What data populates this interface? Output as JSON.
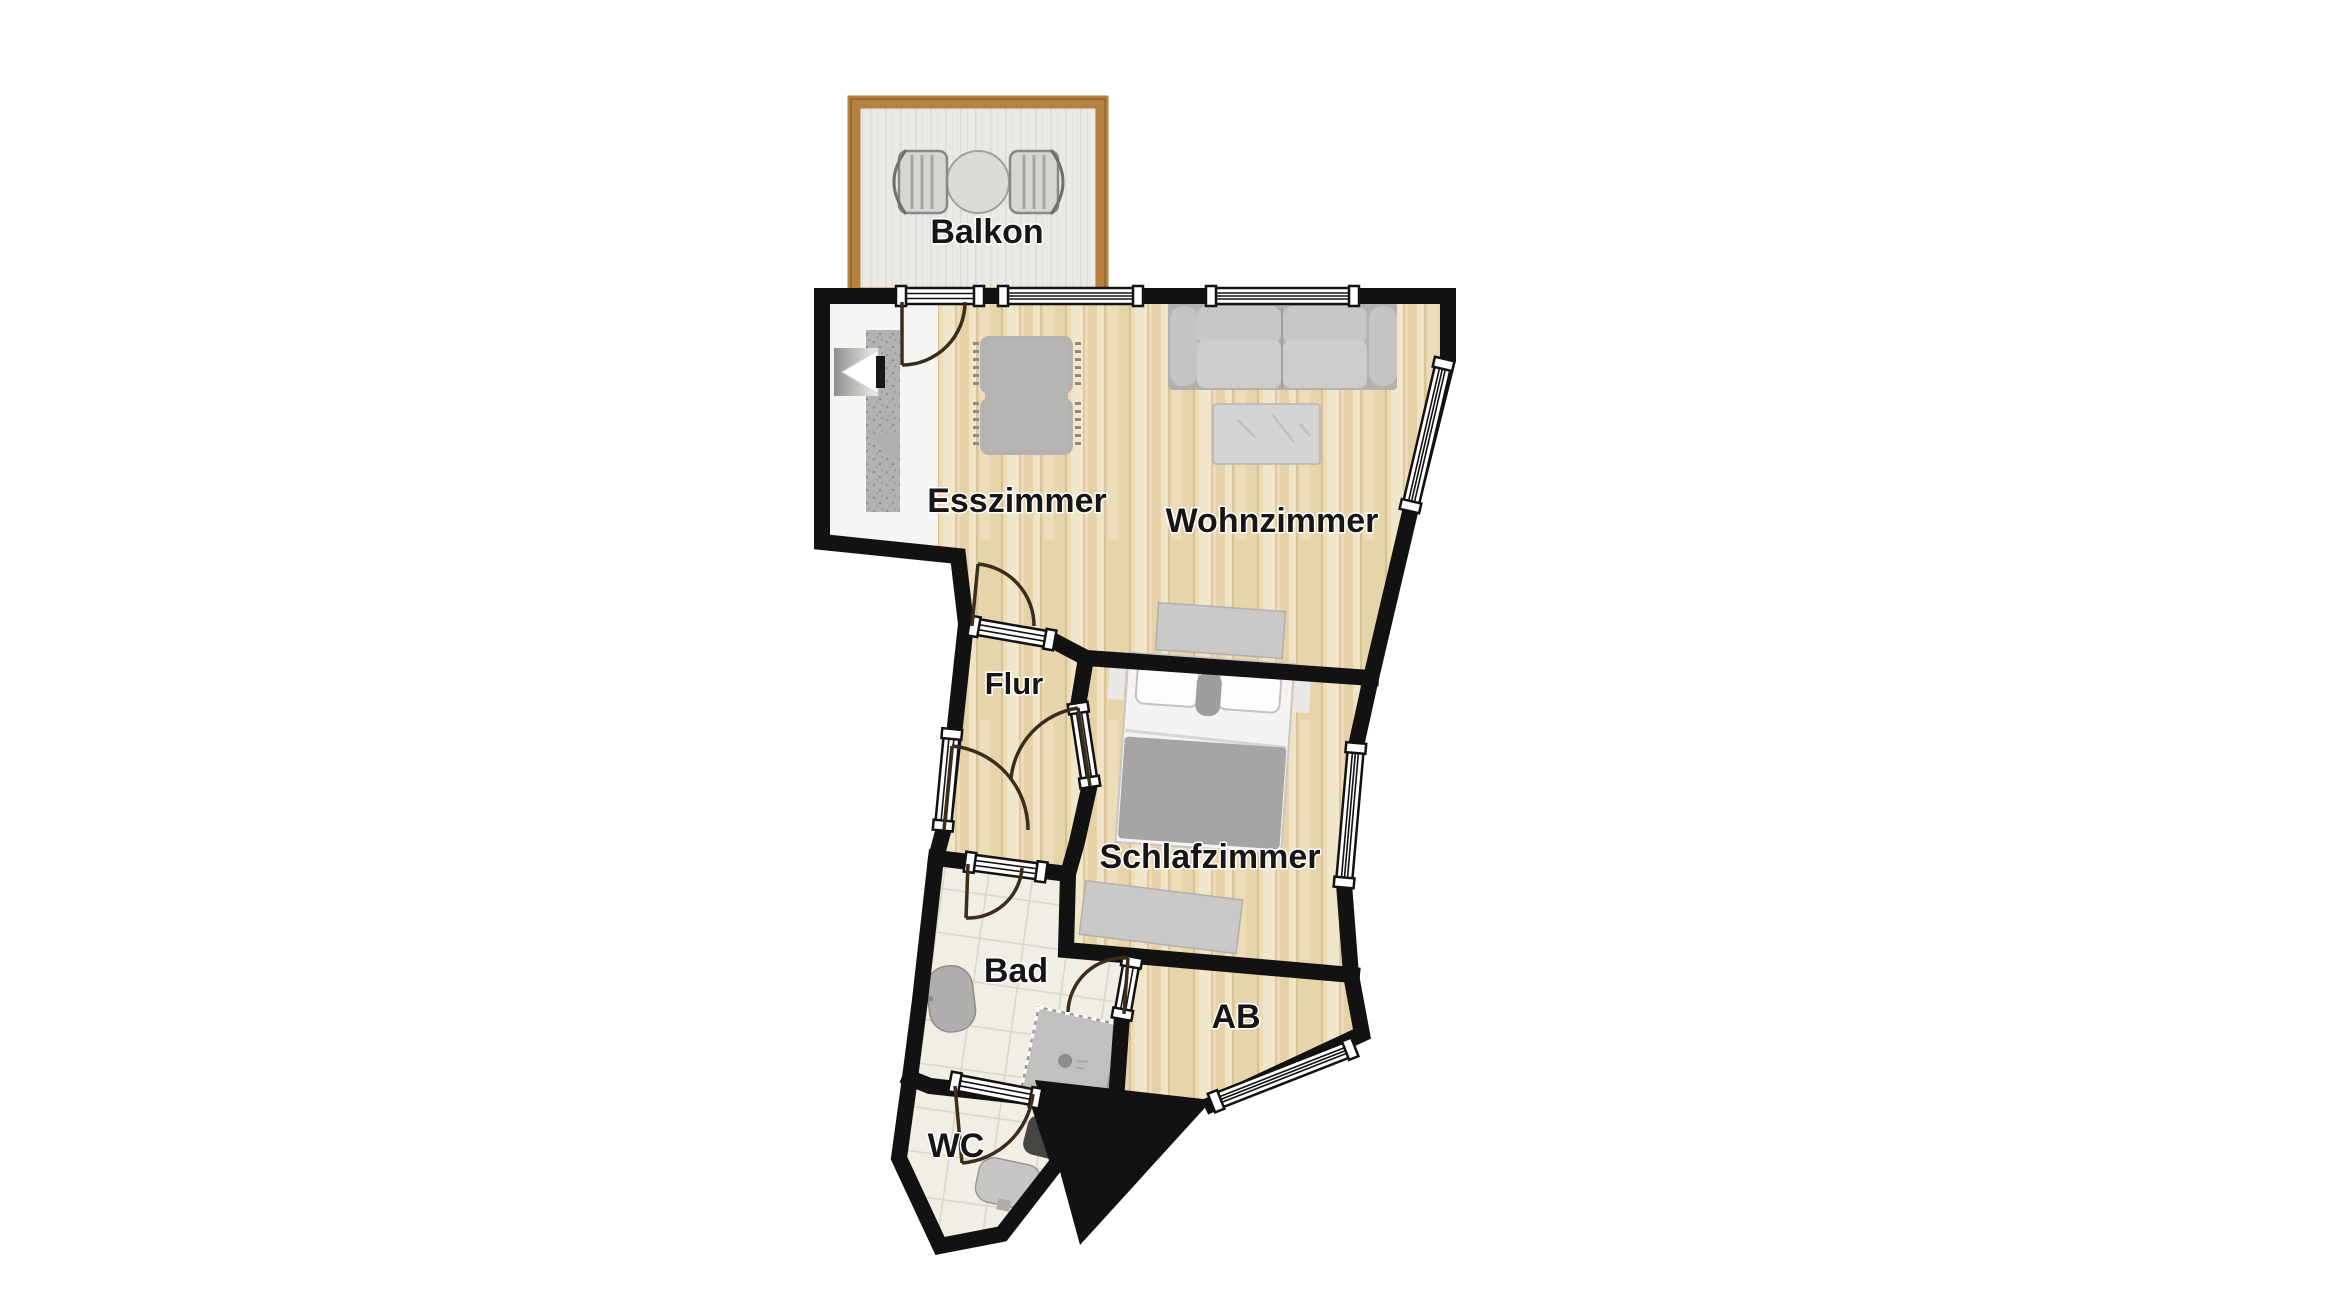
{
  "rooms": {
    "balkon": {
      "label": "Balkon"
    },
    "esszimmer": {
      "label": "Esszimmer"
    },
    "wohnzimmer": {
      "label": "Wohnzimmer"
    },
    "flur": {
      "label": "Flur"
    },
    "schlafzimmer": {
      "label": "Schlafzimmer"
    },
    "bad": {
      "label": "Bad"
    },
    "ab": {
      "label": "AB"
    },
    "wc": {
      "label": "WC"
    }
  },
  "colors": {
    "wall": "#121212",
    "wood": "#ecdcb8",
    "tile": "#f1eee5",
    "tile_line": "#dcd7c8",
    "balcony_frame": "#b5823f",
    "balcony_floor": "#e9e9e5",
    "furniture": "#c8c6c4",
    "furniture_dark": "#b0aeac",
    "blanket": "#a7a5a3",
    "label": "#161616",
    "door_arc": "#3a2d1c"
  }
}
